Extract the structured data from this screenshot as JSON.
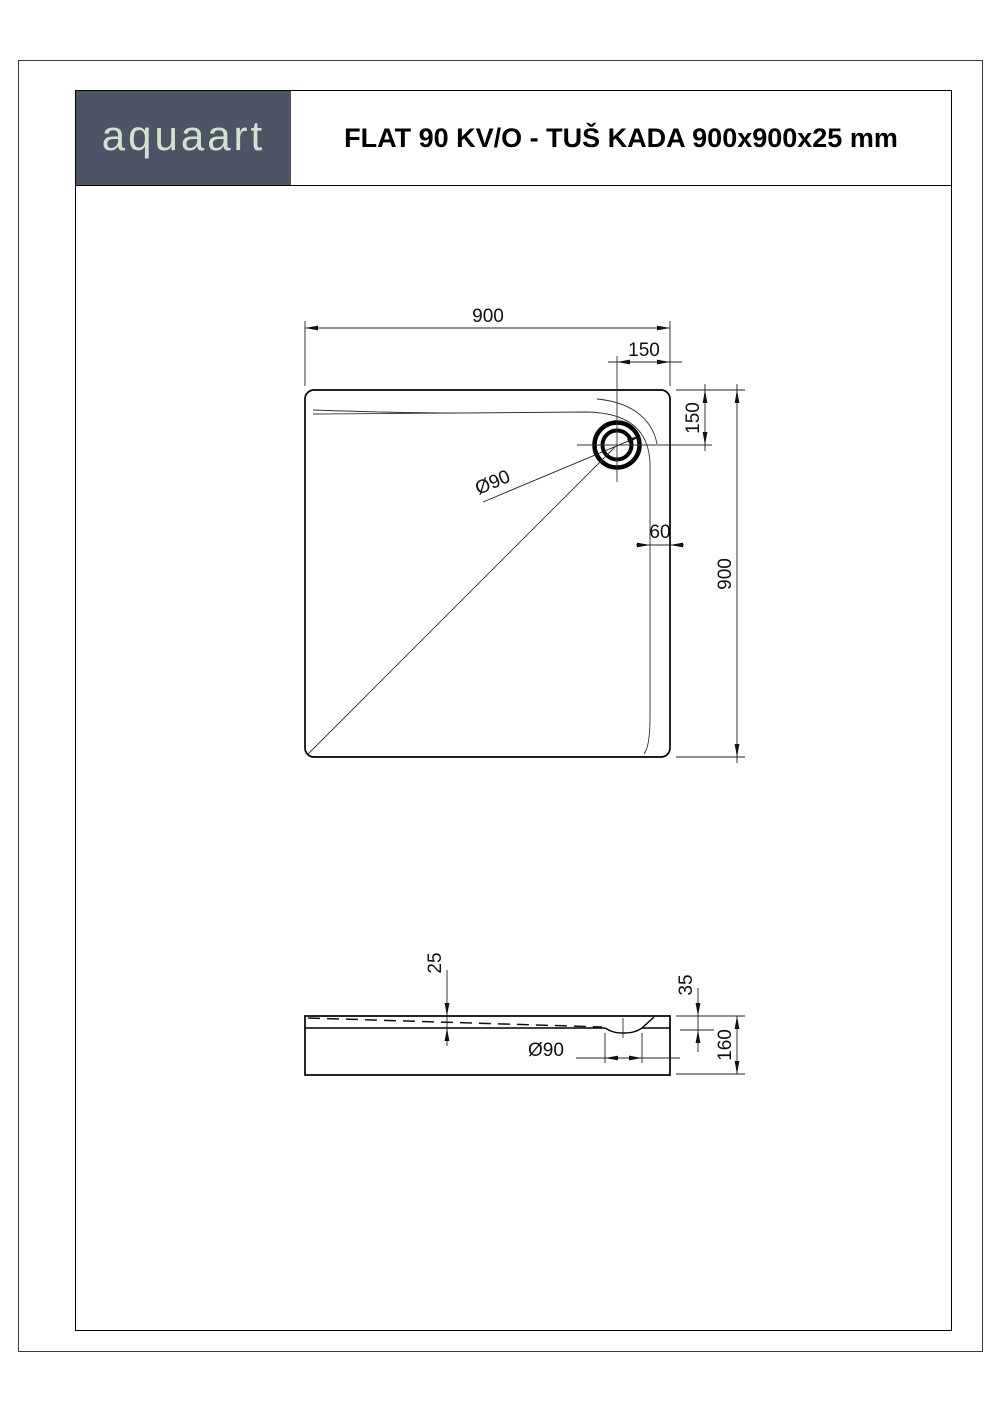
{
  "page": {
    "logo_text": "aquaart",
    "title": "FLAT 90 KV/O - TUŠ KADA 900x900x25 mm"
  },
  "colors": {
    "logo_bg": "#4d5465",
    "logo_text": "#d3e2ce",
    "ink": "#000000"
  },
  "top_view": {
    "width_label": "900",
    "height_label": "900",
    "drain_offset_top_label": "150",
    "drain_offset_right_label": "150",
    "inner_edge_offset_label": "60",
    "drain_label": "Ø90"
  },
  "side_view": {
    "rim_thickness_label": "25",
    "drain_recess_depth_label": "35",
    "total_height_label": "160",
    "drain_label": "Ø90"
  }
}
